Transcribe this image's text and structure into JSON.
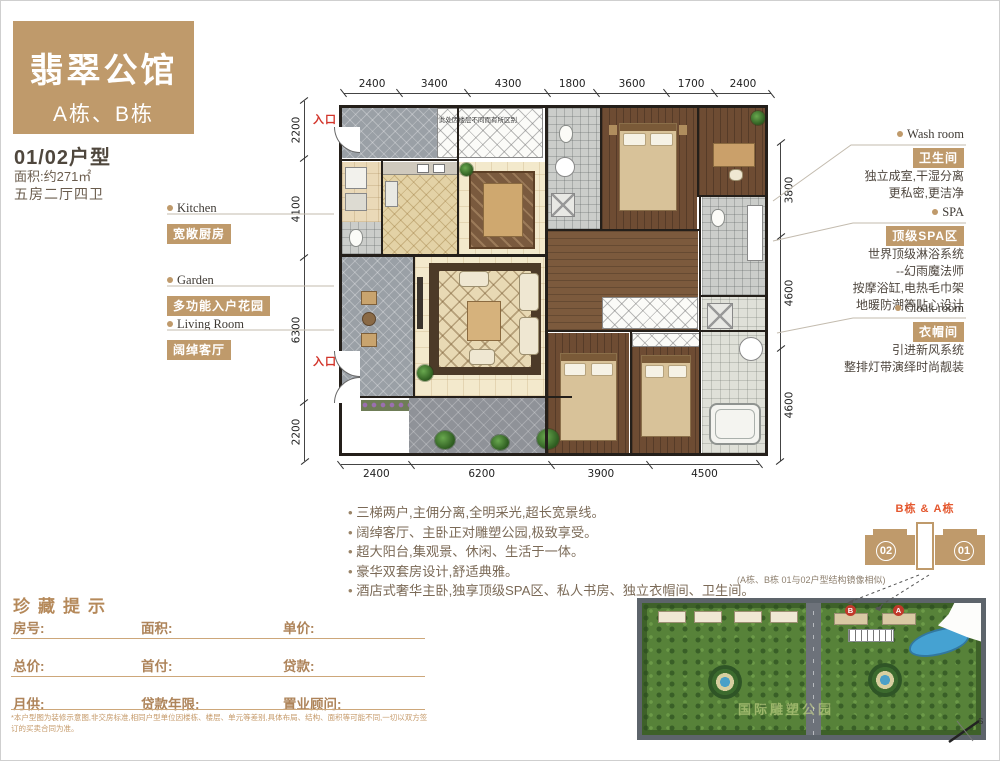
{
  "header": {
    "title": "翡翠公馆",
    "subtitle": "A栋、B栋"
  },
  "unit": {
    "type": "01/02户型",
    "area": "面积:约271㎡",
    "rooms": "五房二厅四卫"
  },
  "left_labels": [
    {
      "en": "Kitchen",
      "badge": "宽敞厨房"
    },
    {
      "en": "Garden",
      "badge": "多功能入户花园"
    },
    {
      "en": "Living Room",
      "badge": "阔绰客厅"
    }
  ],
  "right_labels": [
    {
      "en": "Wash room",
      "badge": "卫生间",
      "lines": [
        "独立成室,干湿分离",
        "更私密,更洁净"
      ]
    },
    {
      "en": "SPA",
      "badge": "顶级SPA区",
      "lines": [
        "世界顶级淋浴系统",
        "--幻雨魔法师",
        "按摩浴缸,电热毛巾架",
        "地暖防潮等贴心设计"
      ]
    },
    {
      "en": "Cloak room",
      "badge": "衣帽间",
      "lines": [
        "引进新风系统",
        "整排灯带演绎时尚靓装"
      ]
    }
  ],
  "plan": {
    "entry_top": "入口",
    "entry_mid": "入口",
    "note": "此处因楼层不同而有所区别",
    "dims_top": [
      "2400",
      "3400",
      "4300",
      "1800",
      "3600",
      "1700",
      "2400"
    ],
    "dims_bottom": [
      "2400",
      "6200",
      "3900",
      "4500"
    ],
    "dims_left": [
      "2200",
      "4100",
      "6300",
      "2200"
    ],
    "dims_right": [
      "3800",
      "4600",
      "4600"
    ]
  },
  "bullets": [
    "三梯两户,主佣分离,全明采光,超长宽景线。",
    "阔绰客厅、主卧正对雕塑公园,极致享受。",
    "超大阳台,集观景、休闲、生活于一体。",
    "豪华双套房设计,舒适典雅。",
    "酒店式奢华主卧,独享顶级SPA区、私人书房、独立衣帽间、卫生间。"
  ],
  "tower_diagram": {
    "label": "B栋 & A栋",
    "left_unit": "02",
    "right_unit": "01",
    "caption": "(A栋、B栋  01与02户型结构镜像相似)"
  },
  "site_plan": {
    "building_b": "B",
    "building_a": "A",
    "watermark": "国际雕塑公园",
    "compass": "S"
  },
  "form": {
    "title": "珍藏提示",
    "rows": [
      [
        "房号:",
        "面积:",
        "单价:"
      ],
      [
        "总价:",
        "首付:",
        "贷款:"
      ],
      [
        "月供:",
        "贷款年限:",
        "置业顾问:"
      ]
    ],
    "disclaimer": "*本户型图为装修示意图,非交房标准,相同户型单位因楼栋、楼层、单元等差别,具体布局、结构、面积等可能不同,一切以双方签订的买卖合同为准。"
  },
  "colors": {
    "accent_tan": "#bf9a6b",
    "accent_red": "#d2342a"
  }
}
